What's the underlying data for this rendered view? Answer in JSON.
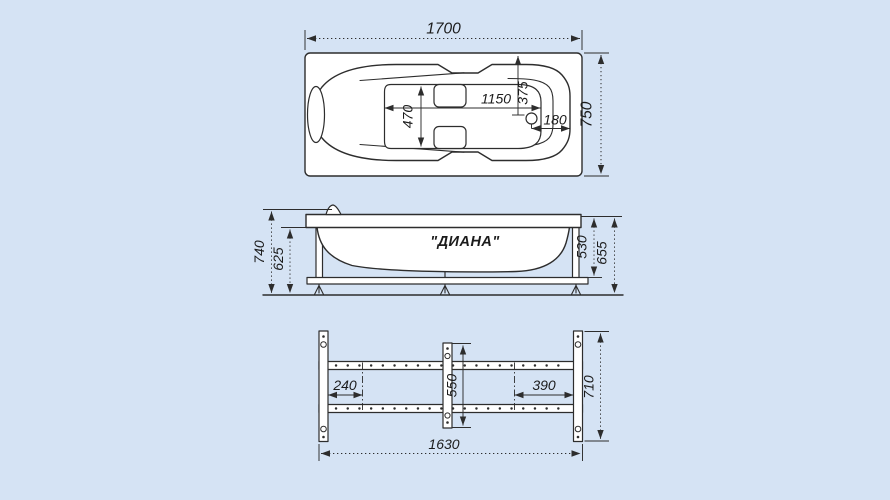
{
  "top_view": {
    "length": "1700",
    "width": "750",
    "inner_length": "1150",
    "drain_offset_from_top": "375",
    "inner_width": "470",
    "drain_offset_from_side": "180"
  },
  "side_view": {
    "model_label": "\"ДИАНА\"",
    "overall_height": "740",
    "height_under_rim": "625",
    "rim_to_frame_rail": "530",
    "rim_to_floor": "655"
  },
  "frame_view": {
    "left_bracket_offset": "240",
    "center_bar_length": "550",
    "right_bracket_offset": "390",
    "frame_length": "1630",
    "frame_width": "710"
  },
  "colors": {
    "background": "#d5e3f4",
    "line": "#2d2d2d",
    "ink": "#1c1c1c",
    "paper": "#ffffff"
  }
}
